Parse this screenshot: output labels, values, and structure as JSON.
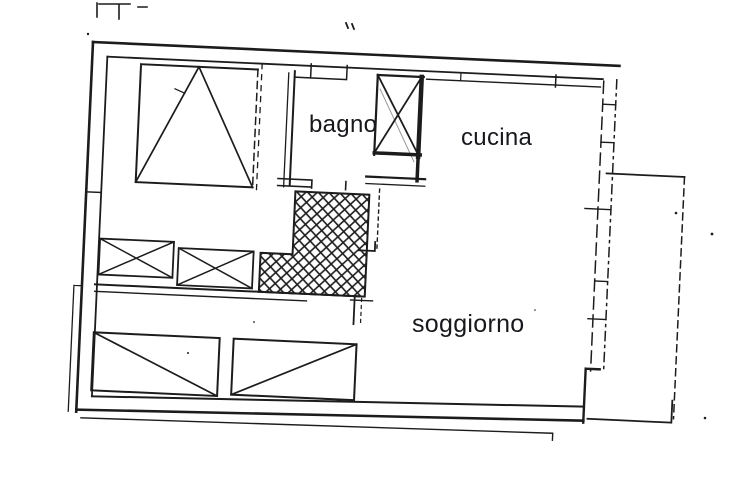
{
  "document": {
    "kind": "scanned floor plan (planimetria)",
    "rotation_degrees": 2.6
  },
  "labels": {
    "bagno": "bagno",
    "cucina": "cucina",
    "soggiorno": "soggiorno"
  },
  "colors": {
    "ink": "#1c1c1c",
    "label_text": "#17181c",
    "background": "#ffffff"
  }
}
